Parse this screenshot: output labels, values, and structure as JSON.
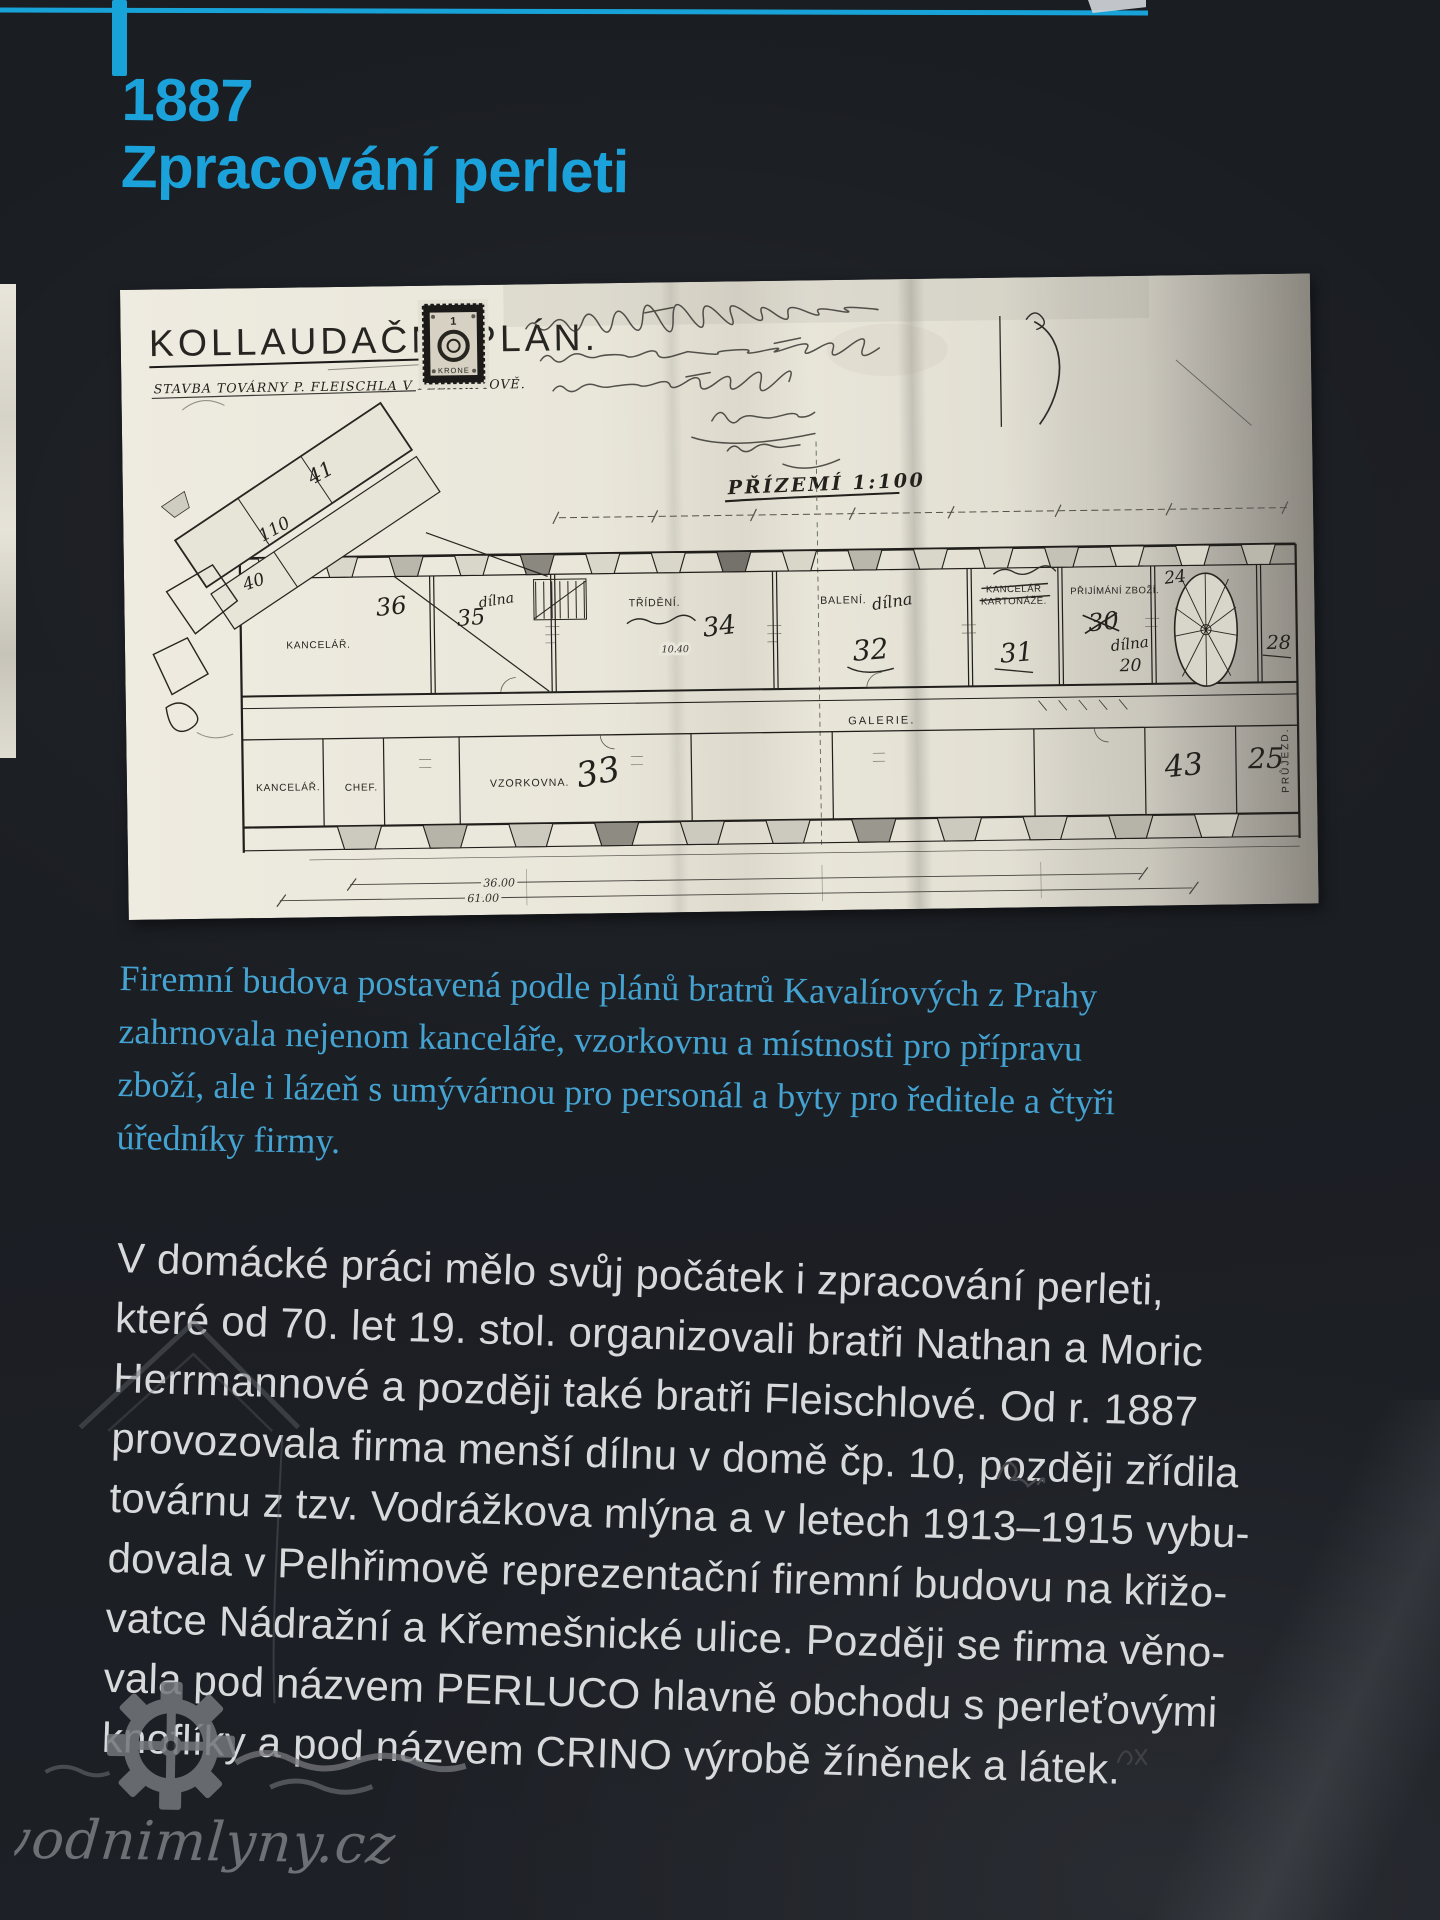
{
  "colors": {
    "accent": "#1ba2da",
    "lead_text": "#45a3d2",
    "body_text": "#d8d9db",
    "background": "#1b1e23",
    "paper": "#eae7dc"
  },
  "heading": {
    "year": "1887",
    "title": "Zpracování perleti"
  },
  "plan": {
    "title": "KOLLAUDAČNÍ PLÁN.",
    "subtitle": "STAVBA TOVÁRNY P. FLEISCHLA V PELHŘIMOVĚ.",
    "floor_scale": "PŘÍZEMÍ 1:100",
    "stamp": {
      "value": "1",
      "unit": "KRONE"
    },
    "rooms": {
      "kancelar": "KANCELÁŘ.",
      "trideni": "TŘÍDĚNÍ.",
      "baleni": "BALENÍ.",
      "kancelar_kartonaze_line1": "KANCELÁŘ",
      "kancelar_kartonaze_line2": "KARTONÁŽE.",
      "prijimani_zbozi": "PŘIJÍMÁNÍ ZBOŽÍ.",
      "galerie": "GALERIE.",
      "vzorkovna": "VZORKOVNA.",
      "chef": "CHEF.",
      "prujezd": "PRŮJEZD."
    },
    "handwritten": {
      "dilna": "dílna",
      "n34": "34",
      "n32": "32",
      "n31": "31",
      "n30": "30",
      "n20": "20",
      "n24": "24",
      "n28": "28",
      "n33": "33",
      "n35": "35",
      "n36": "36",
      "n40": "40",
      "n41": "41",
      "n43": "43",
      "n25": "25",
      "n110": "110"
    },
    "dimensions": {
      "top": "10.40",
      "inner": "36.00",
      "outer": "61.00"
    }
  },
  "lead": {
    "lines": [
      "Firemní budova postavená podle plánů bratrů Kavalírových z Prahy",
      "zahrnovala nejenom kanceláře, vzorkovnu a místnosti pro přípravu",
      "zboží, ale i lázeň s umývárnou pro personál a byty pro ředitele a čtyři",
      "úředníky firmy."
    ]
  },
  "body": {
    "lines": [
      "V domácké práci mělo svůj počátek i zpracování perleti,",
      "které od 70. let 19. stol. organizovali bratři Nathan a Moric",
      "Herrmannové a později také bratři Fleischlové. Od r. 1887",
      "provozovala firma menší dílnu v domě čp. 10, později zřídila",
      "továrnu z tzv. Vodrážkova mlýna a v letech 1913–1915 vybu-",
      "dovala v Pelhřimově reprezentační firemní budovu na křižo-",
      "vatce Nádražní a Křemešnické ulice. Později se firma věno-",
      "vala pod názvem PERLUCO hlavně obchodu s perleťovými",
      "knoflíky a pod názvem CRINO výrobě žíněnek a látek."
    ]
  },
  "watermark": {
    "text": "vodnimlyny.cz"
  }
}
